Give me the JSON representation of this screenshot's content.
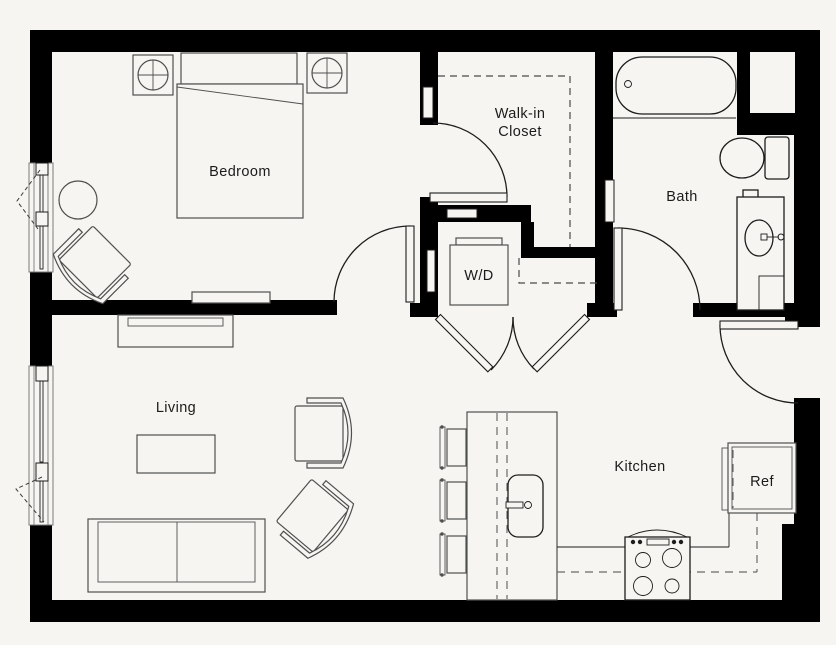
{
  "floorplan": {
    "colors": {
      "floor": "#f6f5f1",
      "wall": "#000000",
      "furniture": "#4f4f4f",
      "fixture": "#1d1d1d",
      "label": "#1b1b1b"
    },
    "rooms": {
      "bedroom": {
        "label": "Bedroom"
      },
      "walk_in_closet": {
        "label_line1": "Walk-in",
        "label_line2": "Closet"
      },
      "bath": {
        "label": "Bath"
      },
      "laundry": {
        "label": "W/D"
      },
      "living": {
        "label": "Living"
      },
      "kitchen": {
        "label": "Kitchen"
      },
      "refrigerator": {
        "label": "Ref"
      }
    }
  }
}
